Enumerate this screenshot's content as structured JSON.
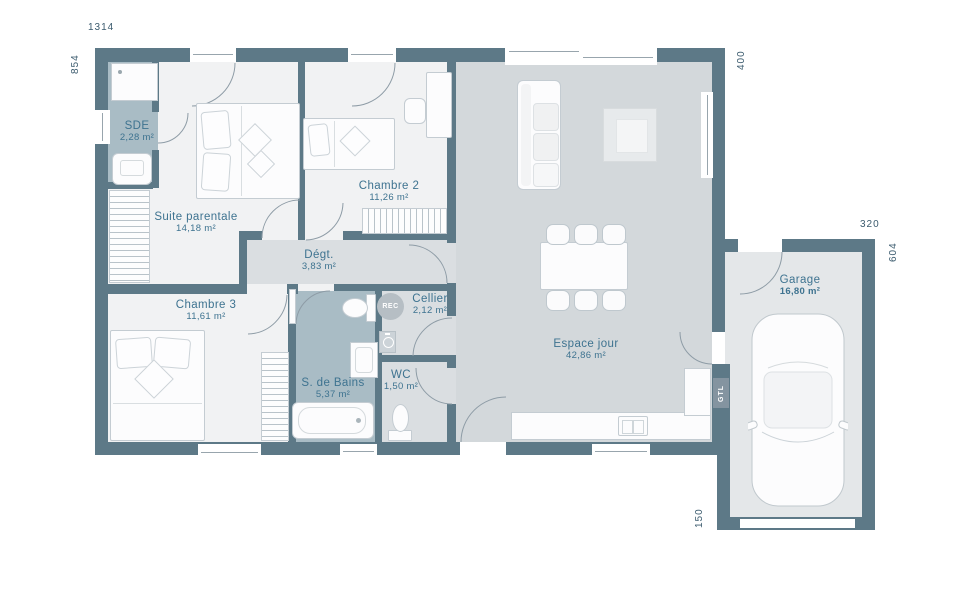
{
  "dims": {
    "width_top": "1314",
    "left_side": "854",
    "right_side": "400",
    "garage_width": "320",
    "garage_depth": "604",
    "garage_offset": "150"
  },
  "rooms": [
    {
      "id": "sde",
      "name": "SDE",
      "area": "2,28 m²"
    },
    {
      "id": "suite",
      "name": "Suite parentale",
      "area": "14,18 m²"
    },
    {
      "id": "chambre2",
      "name": "Chambre 2",
      "area": "11,26 m²"
    },
    {
      "id": "chambre3",
      "name": "Chambre 3",
      "area": "11,61 m²"
    },
    {
      "id": "degt",
      "name": "Dégt.",
      "area": "3,83 m²"
    },
    {
      "id": "cellier",
      "name": "Cellier",
      "area": "2,12 m²"
    },
    {
      "id": "sdb",
      "name": "S. de Bains",
      "area": "5,37 m²"
    },
    {
      "id": "wc",
      "name": "WC",
      "area": "1,50 m²"
    },
    {
      "id": "espace",
      "name": "Espace jour",
      "area": "42,86 m²"
    },
    {
      "id": "garage",
      "name": "Garage",
      "area": "16,80 m²"
    }
  ],
  "annotations": {
    "rec": "REC",
    "gtl": "GTL"
  },
  "colors": {
    "wall": "#5d7987",
    "floor_day": "#d3d8db",
    "floor_wet": "#a9bcc5",
    "label": "#3e7390"
  }
}
